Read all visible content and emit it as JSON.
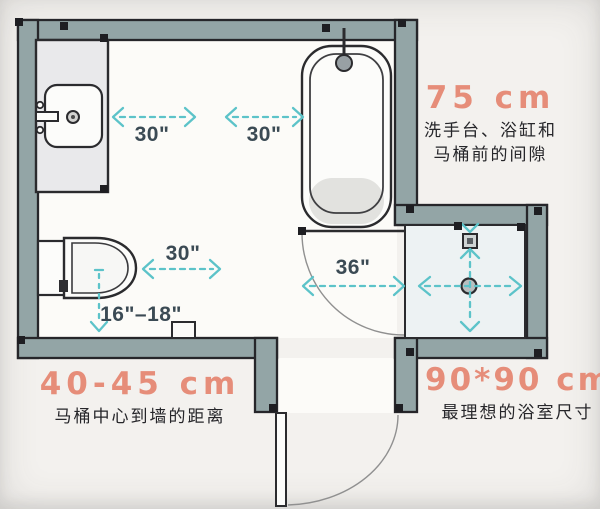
{
  "plan": {
    "measurements": {
      "sink_front": "30\"",
      "tub_front": "30\"",
      "toilet_front": "30\"",
      "doorway": "36\"",
      "toilet_center_to_wall": "16\"–18\""
    },
    "notes": {
      "clearance": {
        "value": "75 cm",
        "line1": "洗手台、浴缸和",
        "line2": "马桶前的间隙"
      },
      "toilet_distance": {
        "value": "40-45 cm",
        "caption": "马桶中心到墙的距离"
      },
      "shower_size": {
        "value": "90*90 cm",
        "caption": "最理想的浴室尺寸"
      }
    },
    "colors": {
      "wall_fill": "#93a5a6",
      "outline": "#26262a",
      "arrow_teal": "#5cc3c9",
      "note_coral": "#e68d79",
      "dim_text": "#3b4a54"
    }
  }
}
